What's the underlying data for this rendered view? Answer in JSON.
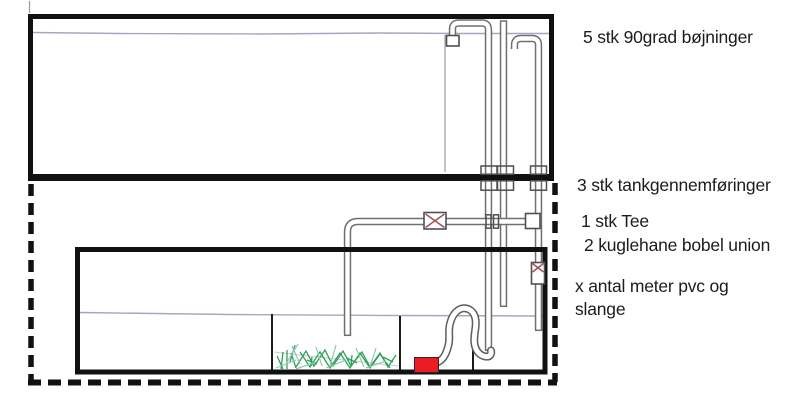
{
  "annotations": [
    {
      "text": "5 stk 90grad bøjninger"
    },
    {
      "text": "3 stk tankgennemføringer"
    },
    {
      "text": "1 stk Tee"
    },
    {
      "text": "2 kuglehane bobel union"
    },
    {
      "text": "x antal meter pvc og"
    },
    {
      "text": "slange"
    }
  ],
  "colors": {
    "ink": "#111111",
    "pipe-gray": "#6f6f6f",
    "waterline": "#a6a6bd",
    "pump-red": "#ea1c24",
    "plant-green": "#2fa05a",
    "plant-green-light": "#8cc9ab",
    "valve-x-red": "#a05757",
    "background": "#ffffff"
  }
}
